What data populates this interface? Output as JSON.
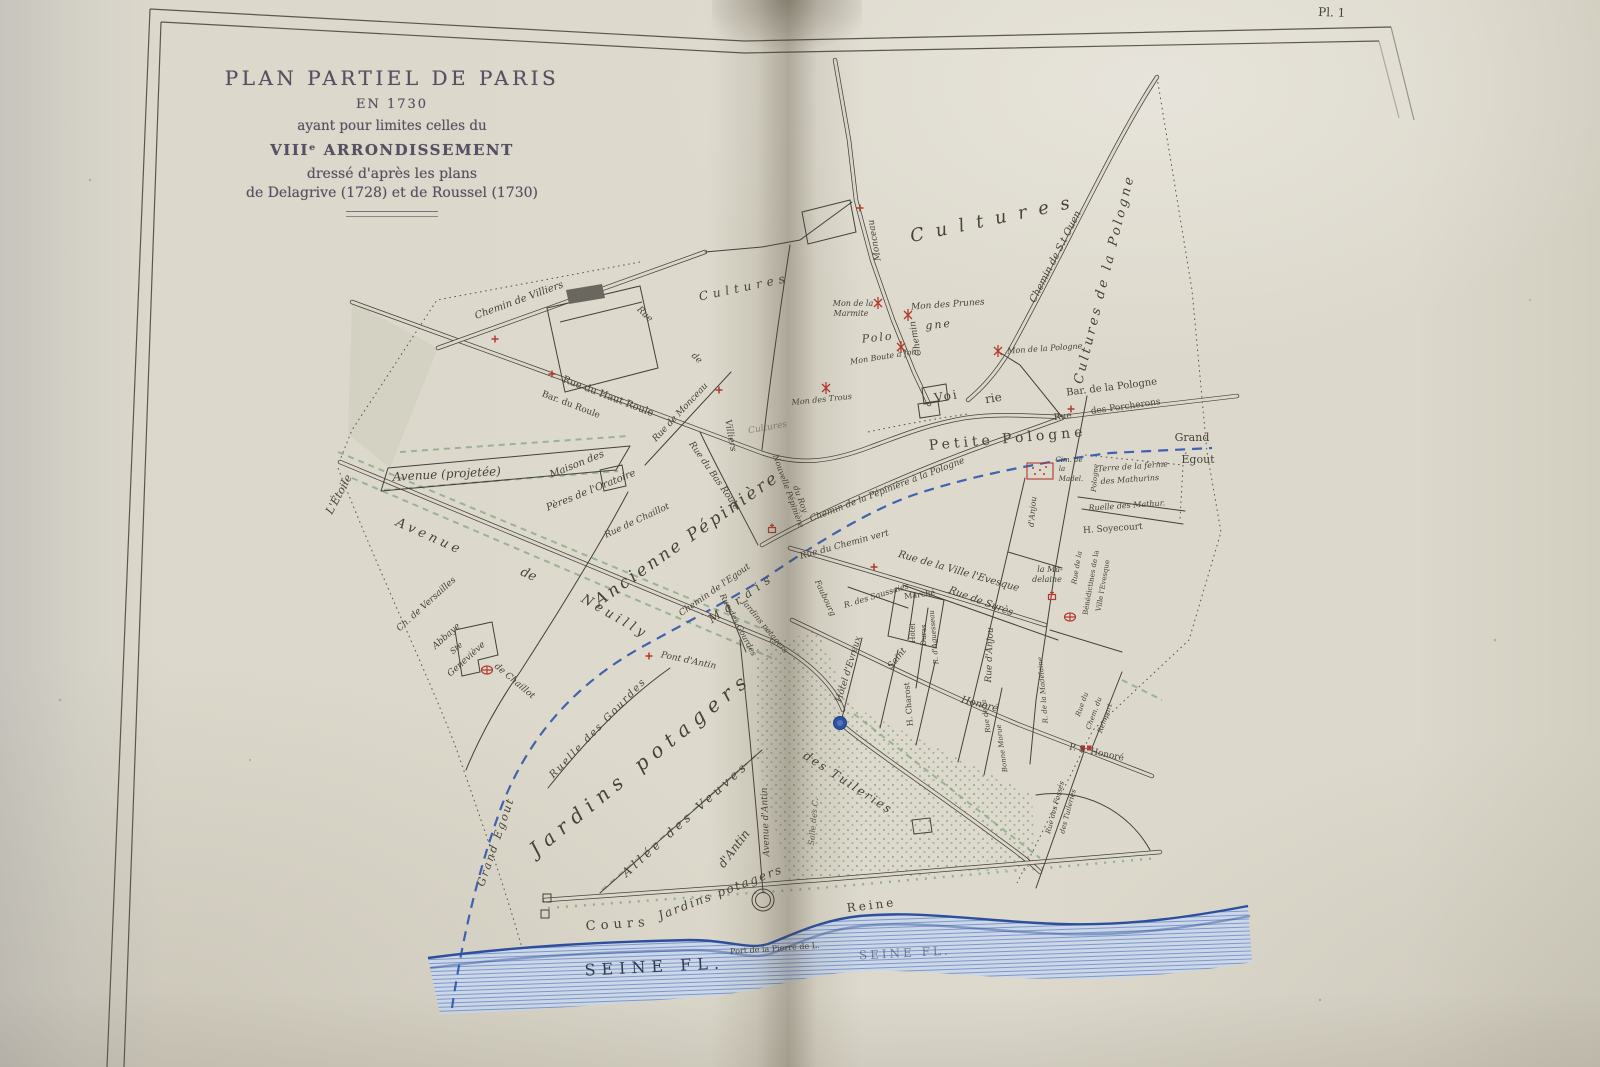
{
  "plate": {
    "number": "Pl. 1"
  },
  "title_block": {
    "line1": "PLAN PARTIEL DE PARIS",
    "line2": "EN 1730",
    "line3": "ayant pour limites celles du",
    "line4": "VIIIᵉ ARRONDISSEMENT",
    "line5": "dressé d'après les plans",
    "line6": "de Delagrive (1728) et de Roussel (1730)"
  },
  "colors": {
    "paper": "#dbd7ca",
    "ink": "#45413a",
    "label_ink": "#474337",
    "red": "#b23a2e",
    "blue": "#2d55ae",
    "green": "#6f9a6d",
    "seine_fill": "#ccd8e8",
    "title_ink": "#555062"
  },
  "map": {
    "labels": [
      {
        "t": "Cultures",
        "x": 745,
        "y": 291,
        "r": -12,
        "s": 12,
        "ls": 5
      },
      {
        "t": "Cultures",
        "x": 997,
        "y": 224,
        "r": -12,
        "s": 18,
        "ls": 12
      },
      {
        "t": "Cultures",
        "x": 768,
        "y": 430,
        "r": -10,
        "s": 9,
        "o": 0.5
      },
      {
        "t": "Cultures de la Pologne",
        "x": 1108,
        "y": 280,
        "r": -76,
        "s": 13,
        "ls": 3
      },
      {
        "t": "Chemin de S.t Ouen",
        "x": 1058,
        "y": 258,
        "r": -63,
        "s": 10
      },
      {
        "t": "Chemin",
        "x": 918,
        "y": 338,
        "r": -100,
        "s": 9
      },
      {
        "t": "Monceau",
        "x": 877,
        "y": 240,
        "r": -100,
        "s": 9
      },
      {
        "t": "Chemin de Villiers",
        "x": 520,
        "y": 303,
        "r": -20,
        "s": 10
      },
      {
        "t": "Rue",
        "x": 643,
        "y": 316,
        "r": 43,
        "s": 9
      },
      {
        "t": "de",
        "x": 695,
        "y": 360,
        "r": 43,
        "s": 9
      },
      {
        "t": "Rue du Haut Roule",
        "x": 607,
        "y": 399,
        "r": 21,
        "s": 10,
        "c": "r"
      },
      {
        "t": "Bar. du Roule",
        "x": 570,
        "y": 407,
        "r": 21,
        "s": 9,
        "c": "r"
      },
      {
        "t": "Rue de Monceau",
        "x": 682,
        "y": 414,
        "r": -47,
        "s": 9
      },
      {
        "t": "Villiers",
        "x": 728,
        "y": 436,
        "r": 80,
        "s": 9
      },
      {
        "t": "Rue du Bas Roule",
        "x": 712,
        "y": 477,
        "r": 55,
        "s": 9
      },
      {
        "t": "Nouvelle Pépinière",
        "x": 786,
        "y": 492,
        "r": 70,
        "s": 8
      },
      {
        "t": "du Roy",
        "x": 798,
        "y": 500,
        "r": 70,
        "s": 8
      },
      {
        "t": "Mon de la",
        "x": 853,
        "y": 306,
        "r": 0,
        "s": 8
      },
      {
        "t": "Marmite",
        "x": 851,
        "y": 316,
        "r": 0,
        "s": 8
      },
      {
        "t": "Mon des Prunes",
        "x": 948,
        "y": 307,
        "r": -4,
        "s": 9
      },
      {
        "t": "Polo",
        "x": 878,
        "y": 341,
        "r": -6,
        "s": 11,
        "ls": 2
      },
      {
        "t": "gne",
        "x": 939,
        "y": 328,
        "r": -6,
        "s": 11,
        "ls": 2
      },
      {
        "t": "Mon Boute à foin",
        "x": 885,
        "y": 359,
        "r": -9,
        "s": 8
      },
      {
        "t": "Mon de la Pologne",
        "x": 1045,
        "y": 351,
        "r": -4,
        "s": 8
      },
      {
        "t": "Mon des Trous",
        "x": 822,
        "y": 402,
        "r": -6,
        "s": 8
      },
      {
        "t": "Voi",
        "x": 947,
        "y": 400,
        "r": -9,
        "s": 12,
        "c": "r",
        "ls": 2
      },
      {
        "t": "rie",
        "x": 994,
        "y": 402,
        "r": -9,
        "s": 12,
        "c": "r"
      },
      {
        "t": "Bar. de la Pologne",
        "x": 1112,
        "y": 390,
        "r": -7,
        "s": 10,
        "c": "r"
      },
      {
        "t": "Rue",
        "x": 1063,
        "y": 419,
        "r": -7,
        "s": 9,
        "c": "r"
      },
      {
        "t": "des Porcherons",
        "x": 1126,
        "y": 409,
        "r": -8,
        "s": 9,
        "c": "r"
      },
      {
        "t": "Petite Pologne",
        "x": 1008,
        "y": 443,
        "r": -5,
        "s": 14,
        "c": "r",
        "ls": 4
      },
      {
        "t": "Grand",
        "x": 1192,
        "y": 441,
        "r": 0,
        "s": 11,
        "c": "r"
      },
      {
        "t": "Égout",
        "x": 1198,
        "y": 463,
        "r": 0,
        "s": 11,
        "c": "r"
      },
      {
        "t": "Chemin de la Pépinière à la Pologne",
        "x": 888,
        "y": 492,
        "r": -21,
        "s": 9
      },
      {
        "t": "Rue du Chemin vert",
        "x": 845,
        "y": 547,
        "r": -15,
        "s": 9
      },
      {
        "t": "Rue de la Ville l'Evesque",
        "x": 958,
        "y": 574,
        "r": 16,
        "s": 10
      },
      {
        "t": "Rue de Surès",
        "x": 980,
        "y": 604,
        "r": 20,
        "s": 10
      },
      {
        "t": "R. des Saussaies",
        "x": 877,
        "y": 598,
        "r": -17,
        "s": 8
      },
      {
        "t": "Faubourg",
        "x": 823,
        "y": 599,
        "r": 65,
        "s": 8
      },
      {
        "t": "Marché",
        "x": 920,
        "y": 597,
        "r": -8,
        "s": 8,
        "c": "r"
      },
      {
        "t": "Hôtel",
        "x": 915,
        "y": 633,
        "r": -90,
        "s": 7,
        "c": "r"
      },
      {
        "t": "Duras",
        "x": 926,
        "y": 635,
        "r": -90,
        "s": 7,
        "c": "r"
      },
      {
        "t": "R. d'Aguesseau",
        "x": 936,
        "y": 637,
        "r": -95,
        "s": 7
      },
      {
        "t": "Rue d'Anjou",
        "x": 992,
        "y": 655,
        "r": -88,
        "s": 9
      },
      {
        "t": "d'Anjou",
        "x": 1035,
        "y": 512,
        "r": -85,
        "s": 8
      },
      {
        "t": "la Ma-",
        "x": 1050,
        "y": 572,
        "r": 0,
        "s": 8
      },
      {
        "t": "delaine",
        "x": 1047,
        "y": 582,
        "r": 0,
        "s": 8
      },
      {
        "t": "Rue de la",
        "x": 1079,
        "y": 568,
        "r": -80,
        "s": 7
      },
      {
        "t": "Bénédictines de la",
        "x": 1093,
        "y": 583,
        "r": -80,
        "s": 7,
        "c": "r"
      },
      {
        "t": "Ville l'Evesque",
        "x": 1105,
        "y": 586,
        "r": -80,
        "s": 7,
        "c": "r"
      },
      {
        "t": "R. de la Madelaine",
        "x": 1045,
        "y": 690,
        "r": -95,
        "s": 7
      },
      {
        "t": "Cim. de",
        "x": 1069,
        "y": 462,
        "r": 0,
        "s": 7
      },
      {
        "t": "la",
        "x": 1062,
        "y": 471,
        "r": 0,
        "s": 7
      },
      {
        "t": "Madel.",
        "x": 1071,
        "y": 481,
        "r": 0,
        "s": 7
      },
      {
        "t": "Terre de la ferme",
        "x": 1133,
        "y": 469,
        "r": -4,
        "s": 8
      },
      {
        "t": "des Mathurins",
        "x": 1130,
        "y": 482,
        "r": -4,
        "s": 8
      },
      {
        "t": "Pologne",
        "x": 1097,
        "y": 478,
        "r": -85,
        "s": 7
      },
      {
        "t": "Ruelle des Mathur.",
        "x": 1127,
        "y": 508,
        "r": -4,
        "s": 8
      },
      {
        "t": "H. Soyecourt",
        "x": 1113,
        "y": 531,
        "r": -4,
        "s": 9,
        "c": "r"
      },
      {
        "t": "Saint",
        "x": 899,
        "y": 660,
        "r": -51,
        "s": 9
      },
      {
        "t": "Honoré",
        "x": 979,
        "y": 707,
        "r": 14,
        "s": 10
      },
      {
        "t": "Hôtel d'Evreux",
        "x": 851,
        "y": 670,
        "r": -73,
        "s": 9
      },
      {
        "t": "H. Charost",
        "x": 911,
        "y": 704,
        "r": -95,
        "s": 8,
        "c": "r"
      },
      {
        "t": "Rue de la",
        "x": 988,
        "y": 716,
        "r": -98,
        "s": 7
      },
      {
        "t": "Bonne Morue",
        "x": 1004,
        "y": 748,
        "r": -98,
        "s": 7
      },
      {
        "t": "Rue du",
        "x": 1084,
        "y": 705,
        "r": -70,
        "s": 7
      },
      {
        "t": "Chem. du",
        "x": 1096,
        "y": 714,
        "r": -70,
        "s": 7
      },
      {
        "t": "Rempart",
        "x": 1107,
        "y": 719,
        "r": -70,
        "s": 7
      },
      {
        "t": "P. S. Honoré",
        "x": 1096,
        "y": 755,
        "r": 12,
        "s": 9,
        "c": "r"
      },
      {
        "t": "Rue des Fossés",
        "x": 1057,
        "y": 808,
        "r": -75,
        "s": 7
      },
      {
        "t": "des Tuileries",
        "x": 1070,
        "y": 812,
        "r": -75,
        "s": 7
      },
      {
        "t": "L'Étoile",
        "x": 342,
        "y": 496,
        "r": -62,
        "s": 11
      },
      {
        "t": "Avenue (projetée)",
        "x": 447,
        "y": 478,
        "r": -3,
        "s": 12
      },
      {
        "t": "Avenue",
        "x": 428,
        "y": 540,
        "r": 24,
        "s": 13,
        "ls": 4
      },
      {
        "t": "de",
        "x": 527,
        "y": 578,
        "r": 24,
        "s": 13
      },
      {
        "t": "Neuilly",
        "x": 613,
        "y": 620,
        "r": 30,
        "s": 13,
        "ls": 4
      },
      {
        "t": "Ch. de Versailles",
        "x": 428,
        "y": 606,
        "r": -42,
        "s": 9
      },
      {
        "t": "Abbaye",
        "x": 448,
        "y": 638,
        "r": -42,
        "s": 9
      },
      {
        "t": "Ste",
        "x": 458,
        "y": 650,
        "r": -42,
        "s": 8
      },
      {
        "t": "Geneviève",
        "x": 468,
        "y": 661,
        "r": -42,
        "s": 9
      },
      {
        "t": "Rue de Chaillot",
        "x": 638,
        "y": 523,
        "r": -25,
        "s": 9
      },
      {
        "t": "de Chaillot",
        "x": 513,
        "y": 683,
        "r": 40,
        "s": 9
      },
      {
        "t": "Maison des",
        "x": 578,
        "y": 467,
        "r": -22,
        "s": 10
      },
      {
        "t": "Pères de l'Oratoire",
        "x": 592,
        "y": 493,
        "r": -22,
        "s": 10
      },
      {
        "t": "Ancienne Pépinière",
        "x": 690,
        "y": 543,
        "r": -35,
        "s": 17,
        "ls": 3
      },
      {
        "t": "Chemin de l'Egout",
        "x": 716,
        "y": 592,
        "r": -35,
        "s": 9
      },
      {
        "t": "Marais",
        "x": 744,
        "y": 601,
        "r": -35,
        "s": 12,
        "ls": 6
      },
      {
        "t": "Jardins potagers",
        "x": 763,
        "y": 628,
        "r": 50,
        "s": 8
      },
      {
        "t": "Rue des Gourdes",
        "x": 736,
        "y": 626,
        "r": 62,
        "s": 8
      },
      {
        "t": "Pont d'Antin",
        "x": 688,
        "y": 663,
        "r": 12,
        "s": 9
      },
      {
        "t": "Grand Egout",
        "x": 499,
        "y": 843,
        "r": -71,
        "s": 11,
        "ls": 2
      },
      {
        "t": "Ruelle des Gourdes",
        "x": 600,
        "y": 730,
        "r": -46,
        "s": 10,
        "ls": 2
      },
      {
        "t": "Jardins potagers",
        "x": 645,
        "y": 769,
        "r": -39,
        "s": 20,
        "ls": 7
      },
      {
        "t": "Allée des Veuves",
        "x": 688,
        "y": 822,
        "r": -42,
        "s": 12,
        "ls": 4
      },
      {
        "t": "Jardins potagers",
        "x": 722,
        "y": 896,
        "r": -21,
        "s": 12,
        "ls": 2
      },
      {
        "t": "d'Antin",
        "x": 737,
        "y": 851,
        "r": -53,
        "s": 12
      },
      {
        "t": "Avenue d'Antin",
        "x": 768,
        "y": 822,
        "r": -92,
        "s": 9
      },
      {
        "t": "des Tuileries",
        "x": 846,
        "y": 786,
        "r": 33,
        "s": 12,
        "ls": 2
      },
      {
        "t": "Salle des C.",
        "x": 816,
        "y": 822,
        "r": -85,
        "s": 8,
        "o": 0.8
      },
      {
        "t": "Cours",
        "x": 618,
        "y": 928,
        "r": -4,
        "s": 13,
        "c": "r",
        "ls": 5
      },
      {
        "t": "Reine",
        "x": 872,
        "y": 909,
        "r": -7,
        "s": 12,
        "c": "r",
        "ls": 3
      },
      {
        "t": "SEINE FL.",
        "x": 655,
        "y": 972,
        "r": -3,
        "s": 16,
        "c": "r b",
        "ls": 6
      },
      {
        "t": "SEINE FL.",
        "x": 905,
        "y": 957,
        "r": -3,
        "s": 12,
        "c": "r b",
        "ls": 3,
        "o": 0.55
      },
      {
        "t": "Port de la Pierre de L.",
        "x": 775,
        "y": 951,
        "r": -4,
        "s": 8,
        "c": "r"
      }
    ],
    "symbols": [
      {
        "k": "windmill",
        "x": 878,
        "y": 303
      },
      {
        "k": "windmill",
        "x": 908,
        "y": 315
      },
      {
        "k": "windmill",
        "x": 901,
        "y": 347
      },
      {
        "k": "windmill",
        "x": 998,
        "y": 351
      },
      {
        "k": "windmill",
        "x": 826,
        "y": 388
      },
      {
        "k": "cross",
        "x": 495,
        "y": 339
      },
      {
        "k": "cross",
        "x": 552,
        "y": 374
      },
      {
        "k": "cross",
        "x": 719,
        "y": 390
      },
      {
        "k": "cross",
        "x": 860,
        "y": 208
      },
      {
        "k": "cross",
        "x": 1071,
        "y": 409
      },
      {
        "k": "cross",
        "x": 874,
        "y": 567
      },
      {
        "k": "cross",
        "x": 649,
        "y": 656
      },
      {
        "k": "church",
        "x": 1052,
        "y": 597
      },
      {
        "k": "church",
        "x": 772,
        "y": 530
      },
      {
        "k": "abbey",
        "x": 487,
        "y": 670
      },
      {
        "k": "abbey",
        "x": 1070,
        "y": 617
      },
      {
        "k": "gate",
        "x": 1086,
        "y": 748
      },
      {
        "k": "cemetery",
        "x": 1040,
        "y": 471
      },
      {
        "k": "pond",
        "x": 840,
        "y": 723
      }
    ]
  }
}
